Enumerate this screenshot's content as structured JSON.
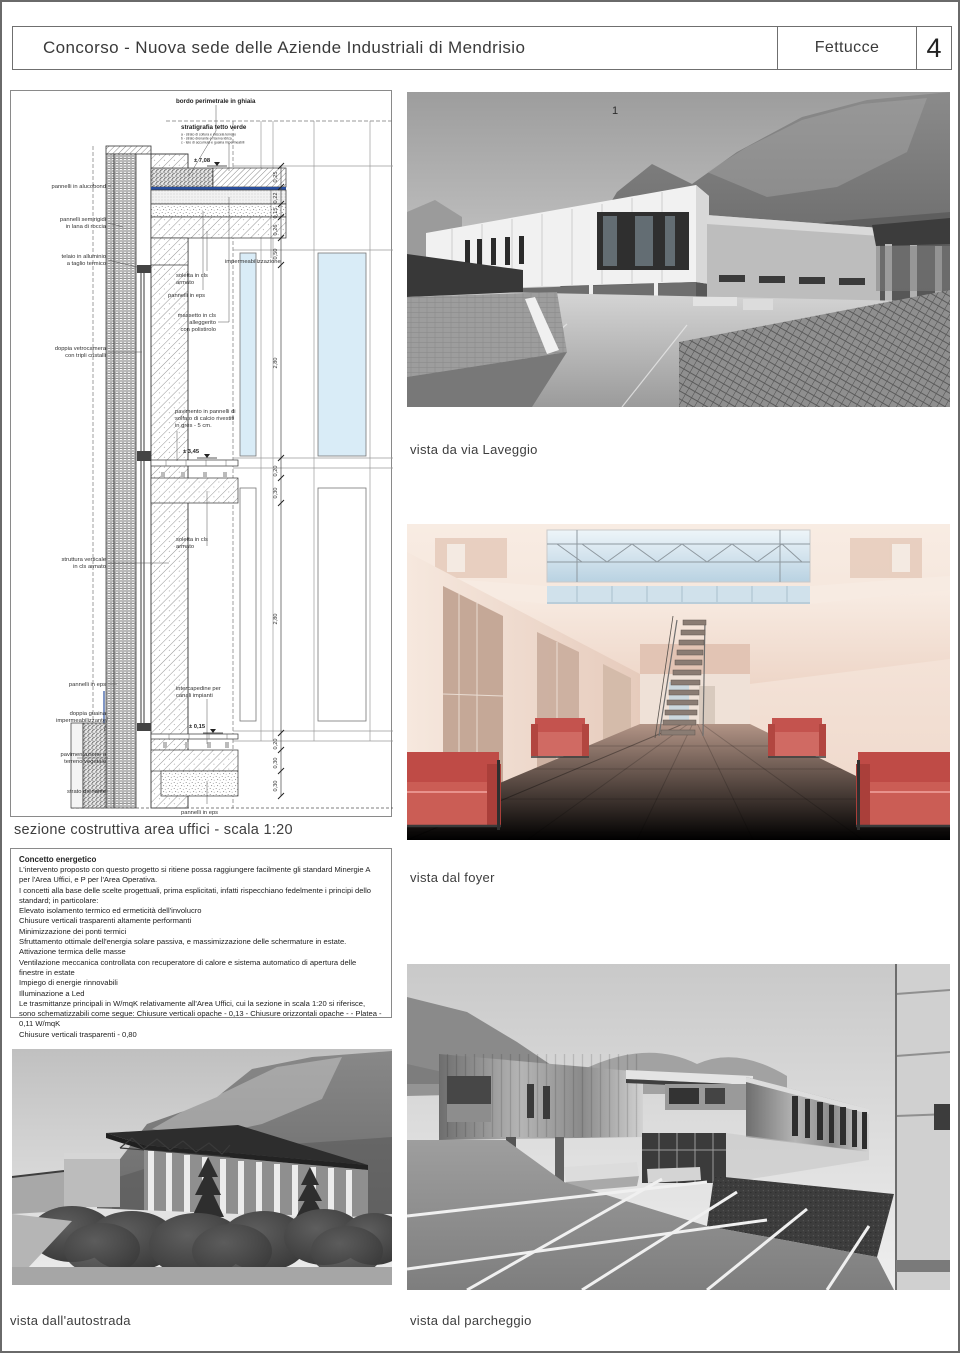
{
  "page": {
    "title": "Concorso - Nuova sede delle Aziende Industriali di Mendrisio",
    "project_tag": "Fettucce",
    "sheet_number": "4"
  },
  "drawing": {
    "caption": "sezione costruttiva area uffici - scala 1:20",
    "levels": {
      "roof": "± 7,08",
      "floor": "± 3,45",
      "ground": "± 0,15"
    },
    "dims_top": [
      "0,25",
      "0,22",
      "0,15",
      "0,26",
      "0,50"
    ],
    "dim_storey_upper": "2,80",
    "dims_mid": [
      "0,20",
      "0,30"
    ],
    "dim_storey_lower": "2,80",
    "dims_bottom": [
      "0,20",
      "0,30",
      "0,30"
    ],
    "labels": {
      "bordo": "bordo perimetrale in ghiaia",
      "strat_title": "stratigrafia tetto verde",
      "strat_a": "a - strato di coltura e miscela terreno",
      "strat_b": "b - strato drenante e riserva idrica",
      "strat_c": "c - telo di accumulo e guaina impermeabili",
      "alucobond": "pannelli in alucobond",
      "semirigidi_1": "pannelli semirigidi",
      "semirigidi_2": "in lana di roccia",
      "telaio_1": "telaio in alluminio",
      "telaio_2": "a taglio termico",
      "imperm": "impermeabilizzazione",
      "soletta_1": "soletta in cls",
      "soletta_2": "armato",
      "eps_roof": "pannelli in eps",
      "massetto_1": "massetto in cls",
      "massetto_2": "alleggerito",
      "massetto_3": "con polistirolo",
      "vetro_1": "doppia vetrocamera",
      "vetro_2": "con tripli cristalli",
      "pavimento_1": "pavimento in pannelli di",
      "pavimento_2": "solfato di calcio rivestiti",
      "pavimento_3": "in grès - 5 cm.",
      "struttura_1": "struttura verticale",
      "struttura_2": "in cls armato",
      "soletta_b_1": "soletta in cls",
      "soletta_b_2": "armato",
      "eps_left": "pannelli in eps",
      "guaina_1": "doppia guaina",
      "guaina_2": "impermeabilizzante",
      "intercap_1": "intercapedine per",
      "intercap_2": "canali impianti",
      "pavimentazione_1": "pavimentazione o",
      "pavimentazione_2": "terreno vegetale",
      "drenante": "strato drenante",
      "eps_bottom": "pannelli in eps"
    }
  },
  "energy": {
    "title": "Concetto energetico",
    "lines": [
      "L'intervento proposto con questo progetto si ritiene possa raggiungere facilmente gli standard Minergie A per l'Area Uffici, e P per l'Area Operativa.",
      "I concetti alla base delle scelte progettuali, prima esplicitati, infatti rispecchiano fedelmente i principi dello standard; in particolare:",
      "Elevato isolamento termico ed ermeticità dell'involucro",
      "Chiusure verticali trasparenti altamente performanti",
      "Minimizzazione dei ponti termici",
      "Sfruttamento ottimale dell'energia solare passiva, e massimizzazione delle schermature in estate.",
      "Attivazione termica delle masse",
      "Ventilazione meccanica controllata con recuperatore di calore e sistema automatico di apertura delle finestre in estate",
      "Impiego di energie rinnovabili",
      "Illuminazione a Led",
      "Le trasmittanze principali in W/mqK relativamente all'Area Uffici, cui la sezione in scala 1:20 si riferisce, sono schematizzabili come segue: Chiusure verticali opache - 0,13 - Chiusure orizzontali opache -  - Platea - 0,11  W/mqK",
      "Chiusure verticali trasparenti - 0,80"
    ]
  },
  "views": {
    "laveggio": {
      "caption": "vista da via Laveggio",
      "marker": "1"
    },
    "foyer": {
      "caption": "vista dal foyer"
    },
    "autostrada": {
      "caption": "vista dall'autostrada"
    },
    "parcheggio": {
      "caption": "vista dal parcheggio"
    }
  },
  "colors": {
    "glass_blue": "#d9ecf7",
    "waterproofing_blue": "#2a4f9e",
    "sofa_red": "#c6504b",
    "page_border": "#6a6a6a"
  }
}
